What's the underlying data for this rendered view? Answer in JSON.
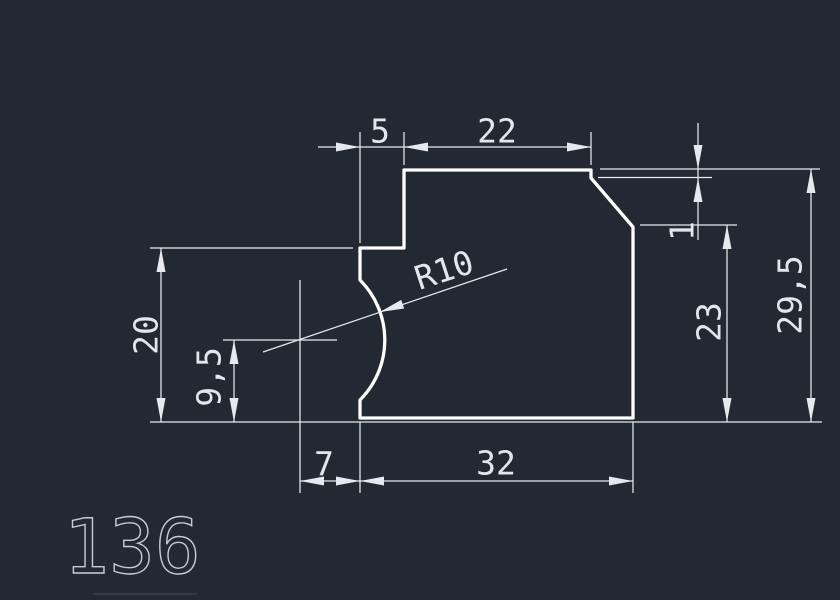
{
  "canvas": {
    "background": "#232933",
    "outline_color": "#fdfdfd",
    "dimension_color": "#e6eaef",
    "part_label_color": "#c7ccd4"
  },
  "drawing": {
    "part_number": "136",
    "dimensions": {
      "top_offset": "5",
      "top_width": "22",
      "step_height": "1",
      "right_height": "23",
      "total_height": "29,5",
      "left_height": "20",
      "arc_center_height": "9,5",
      "arc_center_offset": "7",
      "bottom_width": "32",
      "arc_radius": "R10"
    }
  }
}
